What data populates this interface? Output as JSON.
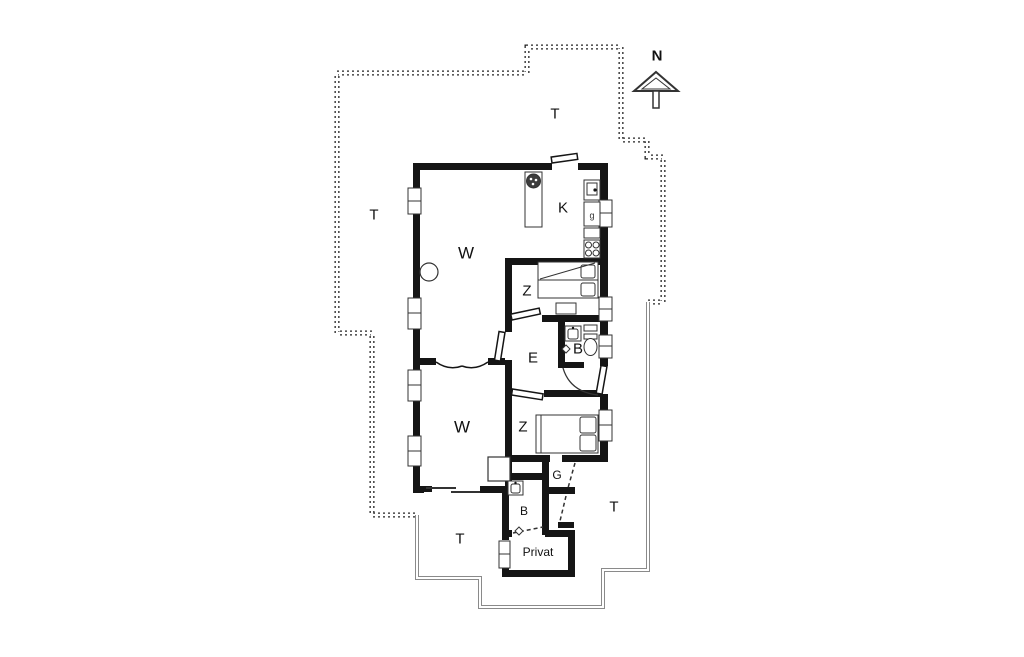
{
  "plan": {
    "compass": "N",
    "rooms": {
      "terrace_top": "T",
      "terrace_left": "T",
      "terrace_right": "T",
      "terrace_bottom": "T",
      "living_upper": "W",
      "kitchen": "K",
      "bedroom_upper": "Z",
      "entry": "E",
      "bath_upper": "B",
      "living_lower": "W",
      "bedroom_lower": "Z",
      "hall": "G",
      "bath_lower": "B",
      "private_room": "Privat",
      "appliance": "g"
    },
    "colors": {
      "wall": "#151515",
      "boundary_dotted": "#222222",
      "boundary_solid": "#8a8a8a",
      "background": "#ffffff"
    }
  }
}
